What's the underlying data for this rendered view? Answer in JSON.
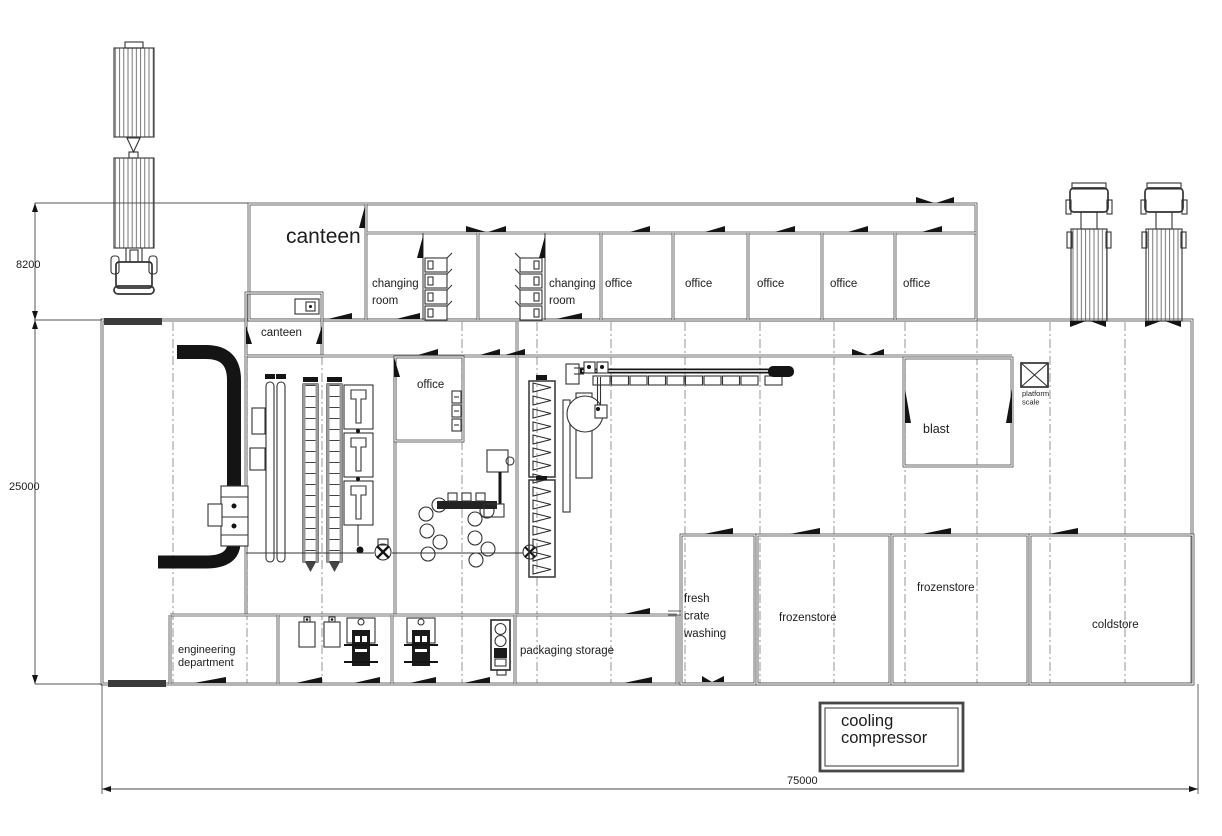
{
  "dimensions": {
    "apron_depth": "8200",
    "hall_depth": "25000",
    "total_length": "75000"
  },
  "rooms": {
    "canteen_main": "canteen",
    "canteen_small": "canteen",
    "changing_room_1": "changing\nroom",
    "changing_room_2": "changing\nroom",
    "office_top_1": "office",
    "office_top_2": "office",
    "office_top_3": "office",
    "office_top_4": "office",
    "office_top_5": "office",
    "office_hall": "office",
    "blast": "blast",
    "platform_scale": "platform\nscale",
    "fresh_crate_washing": "fresh\ncrate\nwashing",
    "frozenstore_small": "frozenstore",
    "frozenstore_large": "frozenstore",
    "coldstore": "coldstore",
    "engineering_department": "engineering\ndepartment",
    "packaging_storage": "packaging storage",
    "cooling_compressor": "cooling\ncompressor"
  },
  "colors": {
    "wall": "#474747",
    "machine": "#333333",
    "solid": "#141414",
    "background": "#ffffff"
  }
}
